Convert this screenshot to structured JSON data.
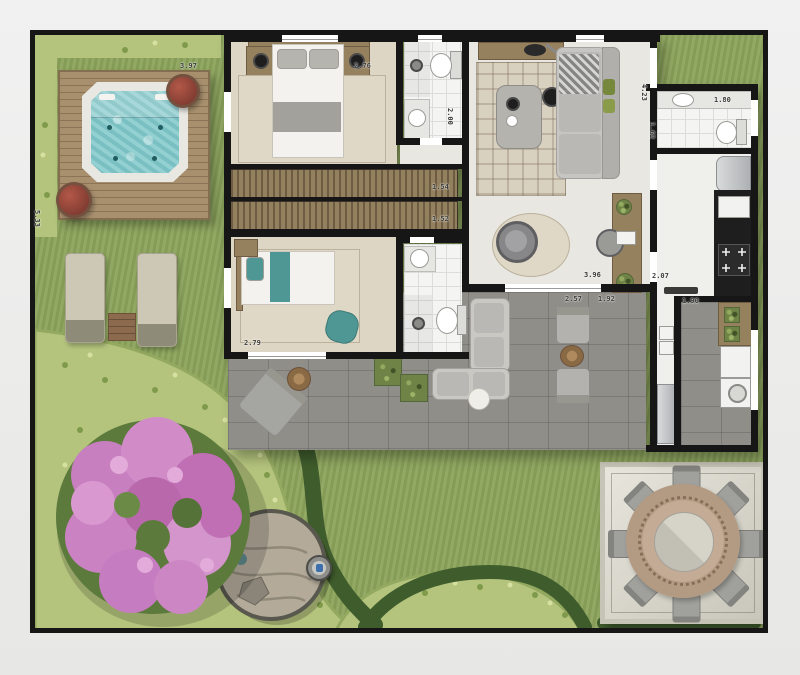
{
  "plan": {
    "type": "residential-garden-apartment-floor-plan",
    "areas": [
      "garden",
      "wood-deck",
      "hot-tub",
      "sun-loungers",
      "flowering-tree",
      "stone-circle",
      "outdoor-dining-patio",
      "terrace",
      "master-bedroom",
      "bedroom-2",
      "bathroom-1",
      "bathroom-2",
      "service-bathroom",
      "wardrobe-closets",
      "living-room",
      "kitchen",
      "laundry"
    ]
  },
  "colors": {
    "wall": "#161616",
    "grass": "#8ca45c",
    "hedge-light": "#b4c47d",
    "hedge-dark": "#3f5c2c",
    "deck": "#a28a68",
    "water": "#84cacc",
    "paver": "#908e89",
    "floor": "#e9e7e2",
    "tile": "#f4f4f2",
    "carpet": "#ded6c5",
    "rug": "#e0d8c6",
    "wood": "#96815f",
    "wood-dark": "#6f5c42",
    "sofa": "#c6c5c1",
    "pink": "#cd84c4",
    "stone": "#b3aa99",
    "patio": "#dedcd2",
    "teal": "#4f9795",
    "steel": "#c7c9ca",
    "counter": "#1e1e1e"
  },
  "dimension_labels": [
    {
      "text": "3.97",
      "x": 180,
      "y": 62,
      "v": false
    },
    {
      "text": "5.33",
      "x": 33,
      "y": 210,
      "v": true
    },
    {
      "text": "2.76",
      "x": 354,
      "y": 62,
      "v": false
    },
    {
      "text": "2.00",
      "x": 446,
      "y": 108,
      "v": true
    },
    {
      "text": "1.54",
      "x": 432,
      "y": 183,
      "v": false
    },
    {
      "text": "1.52",
      "x": 432,
      "y": 215,
      "v": false
    },
    {
      "text": "2.79",
      "x": 244,
      "y": 339,
      "v": false
    },
    {
      "text": "3.96",
      "x": 584,
      "y": 271,
      "v": false
    },
    {
      "text": "2.07",
      "x": 652,
      "y": 272,
      "v": false
    },
    {
      "text": "2.57",
      "x": 565,
      "y": 295,
      "v": false
    },
    {
      "text": "1.92",
      "x": 598,
      "y": 295,
      "v": false
    },
    {
      "text": "1.90",
      "x": 682,
      "y": 297,
      "v": false
    },
    {
      "text": "1.80",
      "x": 714,
      "y": 96,
      "v": false
    },
    {
      "text": "1.62",
      "x": 648,
      "y": 122,
      "v": true
    },
    {
      "text": "4.23",
      "x": 640,
      "y": 84,
      "v": true
    }
  ]
}
